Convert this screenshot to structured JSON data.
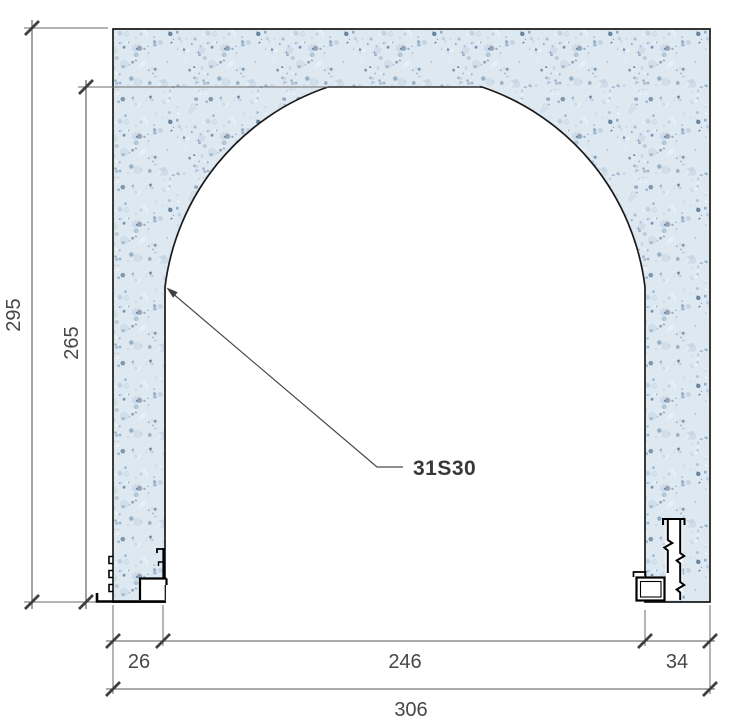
{
  "drawing": {
    "callout_label": "31S30",
    "dimensions": {
      "overall_height": "295",
      "opening_height": "265",
      "left_wall_width": "26",
      "opening_width": "246",
      "right_wall_width": "34",
      "overall_width": "306"
    },
    "colors": {
      "hatch_base": "#dde8f1",
      "speckle_light": "#c4d4e3",
      "speckle_mid": "#9ab2c9",
      "speckle_deep": "#6e8fae",
      "speckle_dark": "#3d5e80",
      "speckle_pale": "#eef4f9",
      "outline": "#1a1a1a",
      "dimension_line": "#575757",
      "dimension_text": "#474747",
      "callout_text": "#383838"
    }
  }
}
